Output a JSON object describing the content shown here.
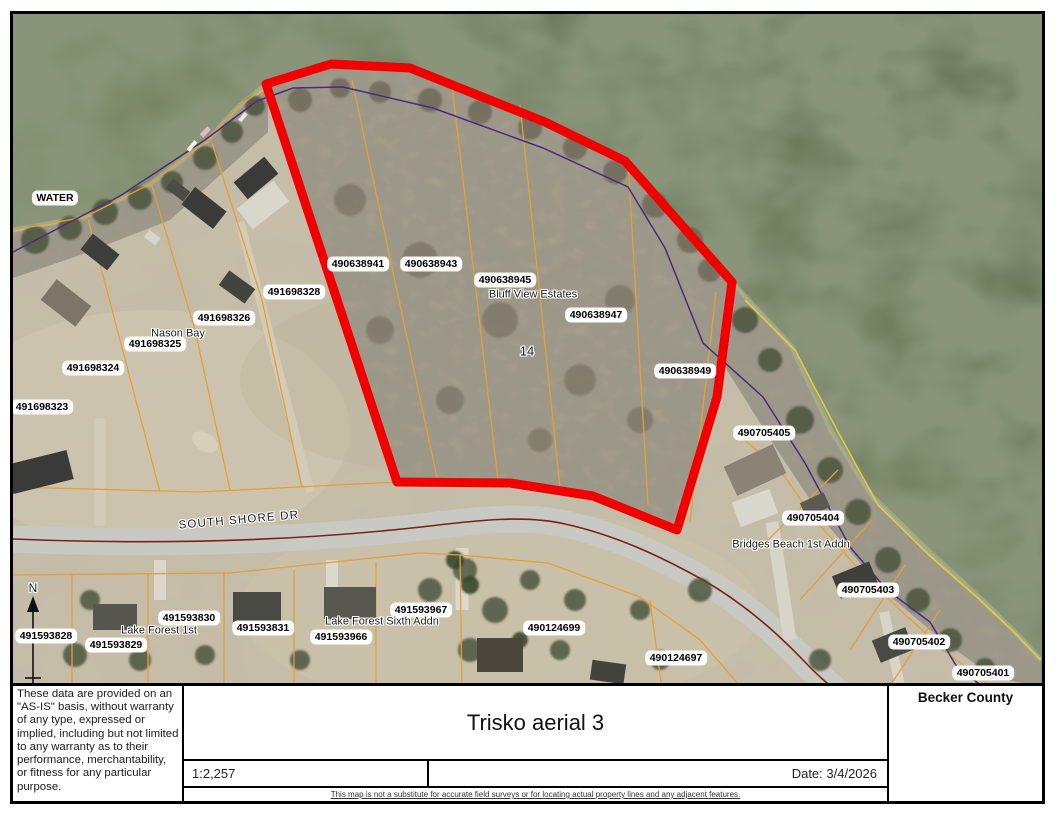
{
  "title_block": {
    "disclaimer": "These data are provided on an \"AS-IS\" basis, without warranty of any type, expressed or implied, including but not limited to any warranty as to their performance, merchantability, or fitness for any particular purpose.",
    "map_title": "Trisko aerial 3",
    "county": "Becker County",
    "scale": "1:2,257",
    "date": "Date: 3/4/2026",
    "fine_print": "This map is not a substitute for accurate field surveys or for locating actual property lines and any adjacent features."
  },
  "map": {
    "labels": [
      {
        "text": "WATER",
        "x": 55,
        "y": 198,
        "style": "box"
      },
      {
        "text": "491698328",
        "x": 294,
        "y": 292,
        "style": "box"
      },
      {
        "text": "491698326",
        "x": 224,
        "y": 318,
        "style": "box"
      },
      {
        "text": "491698325",
        "x": 155,
        "y": 344,
        "style": "box"
      },
      {
        "text": "491698324",
        "x": 93,
        "y": 368,
        "style": "box"
      },
      {
        "text": "491698323",
        "x": 42,
        "y": 407,
        "style": "box"
      },
      {
        "text": "490638941",
        "x": 358,
        "y": 264,
        "style": "box"
      },
      {
        "text": "490638943",
        "x": 431,
        "y": 264,
        "style": "box"
      },
      {
        "text": "490638945",
        "x": 505,
        "y": 280,
        "style": "box"
      },
      {
        "text": "490638947",
        "x": 596,
        "y": 315,
        "style": "box"
      },
      {
        "text": "490638949",
        "x": 685,
        "y": 371,
        "style": "box"
      },
      {
        "text": "490705405",
        "x": 764,
        "y": 433,
        "style": "box"
      },
      {
        "text": "490705404",
        "x": 813,
        "y": 518,
        "style": "box"
      },
      {
        "text": "490705403",
        "x": 868,
        "y": 590,
        "style": "box"
      },
      {
        "text": "490705402",
        "x": 919,
        "y": 642,
        "style": "box"
      },
      {
        "text": "490705401",
        "x": 983,
        "y": 673,
        "style": "box"
      },
      {
        "text": "490124699",
        "x": 554,
        "y": 628,
        "style": "box"
      },
      {
        "text": "490124697",
        "x": 676,
        "y": 658,
        "style": "box"
      },
      {
        "text": "491593828",
        "x": 46,
        "y": 636,
        "style": "box"
      },
      {
        "text": "491593829",
        "x": 116,
        "y": 645,
        "style": "box"
      },
      {
        "text": "491593830",
        "x": 189,
        "y": 618,
        "style": "box"
      },
      {
        "text": "491593831",
        "x": 263,
        "y": 628,
        "style": "box"
      },
      {
        "text": "491593966",
        "x": 341,
        "y": 637,
        "style": "box"
      },
      {
        "text": "491593967",
        "x": 421,
        "y": 610,
        "style": "box"
      },
      {
        "text": "Nason Bay",
        "x": 178,
        "y": 334,
        "style": "halo"
      },
      {
        "text": "Bluff View Estates",
        "x": 533,
        "y": 295,
        "style": "halo"
      },
      {
        "text": "14",
        "x": 527,
        "y": 352,
        "style": "halo",
        "size": 13
      },
      {
        "text": "Lake Forest 1st",
        "x": 159,
        "y": 631,
        "style": "halo"
      },
      {
        "text": "Lake Forest Sixth Addn",
        "x": 382,
        "y": 622,
        "style": "halo"
      },
      {
        "text": "Bridges Beach 1st Addn",
        "x": 791,
        "y": 545,
        "style": "halo"
      },
      {
        "text": "SOUTH SHORE DR",
        "x": 239,
        "y": 521,
        "style": "halo",
        "rot": -5,
        "size": 11.5,
        "spacing": 1.2
      },
      {
        "text": "N",
        "x": 33,
        "y": 589,
        "style": "halo",
        "size": 12
      }
    ]
  },
  "colors": {
    "highlight_red": "#f10000",
    "parcel_line": "#e79f35",
    "boundary_purple": "#4b2a82",
    "shore_yellow": "#dfcb40",
    "road_centerline": "#7c2013",
    "water_dark": "#526044",
    "water_light": "#9aa27b",
    "land": "#c7bea8"
  }
}
